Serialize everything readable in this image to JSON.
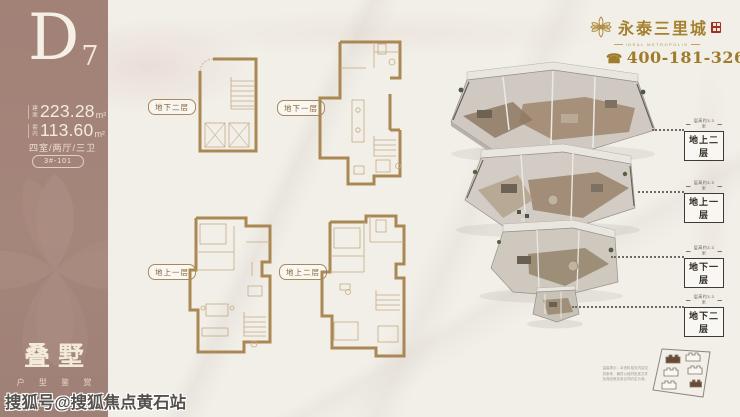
{
  "sidebar": {
    "unit_letter": "D",
    "unit_digit": "7",
    "tagline_dots": "· · · · · · · · · ·",
    "areas": [
      {
        "prefix": "建面",
        "value": "223.28",
        "unit": "m²"
      },
      {
        "prefix": "套内",
        "value": "113.60",
        "unit": "m²"
      }
    ],
    "rooms": "四室/两厅/三卫",
    "badge": "3#-101",
    "product_name": "叠墅",
    "product_caption": "户 型 鉴 赏",
    "product_caption_en": "· · · ·"
  },
  "brand": {
    "name": "永泰三里城",
    "subtitle": "IDEAL METROPOLIS",
    "phone": "400-181-3268",
    "phone_icon": "☎"
  },
  "plans": [
    {
      "label": "地下二层"
    },
    {
      "label": "地下一层"
    },
    {
      "label": "地上一层"
    },
    {
      "label": "地上二层"
    }
  ],
  "iso_levels": [
    {
      "label": "地上二层",
      "caption": "层高约3.3米"
    },
    {
      "label": "地上一层",
      "caption": "层高约3.3米"
    },
    {
      "label": "地下一层",
      "caption": "层高约3.3米"
    },
    {
      "label": "地下二层",
      "caption": "层高约3.3米"
    }
  ],
  "site_plan": {
    "disclaimer": "温馨提示：本资料相关内容仅供参考，最终以政府批准文件及商品房买卖合同约定为准。"
  },
  "watermark": "搜狐号@搜狐焦点黄石站",
  "colors": {
    "sidebar": "#a28177",
    "gold": "#a5812f",
    "plan_line": "#a98853",
    "ink": "#2e2922"
  }
}
